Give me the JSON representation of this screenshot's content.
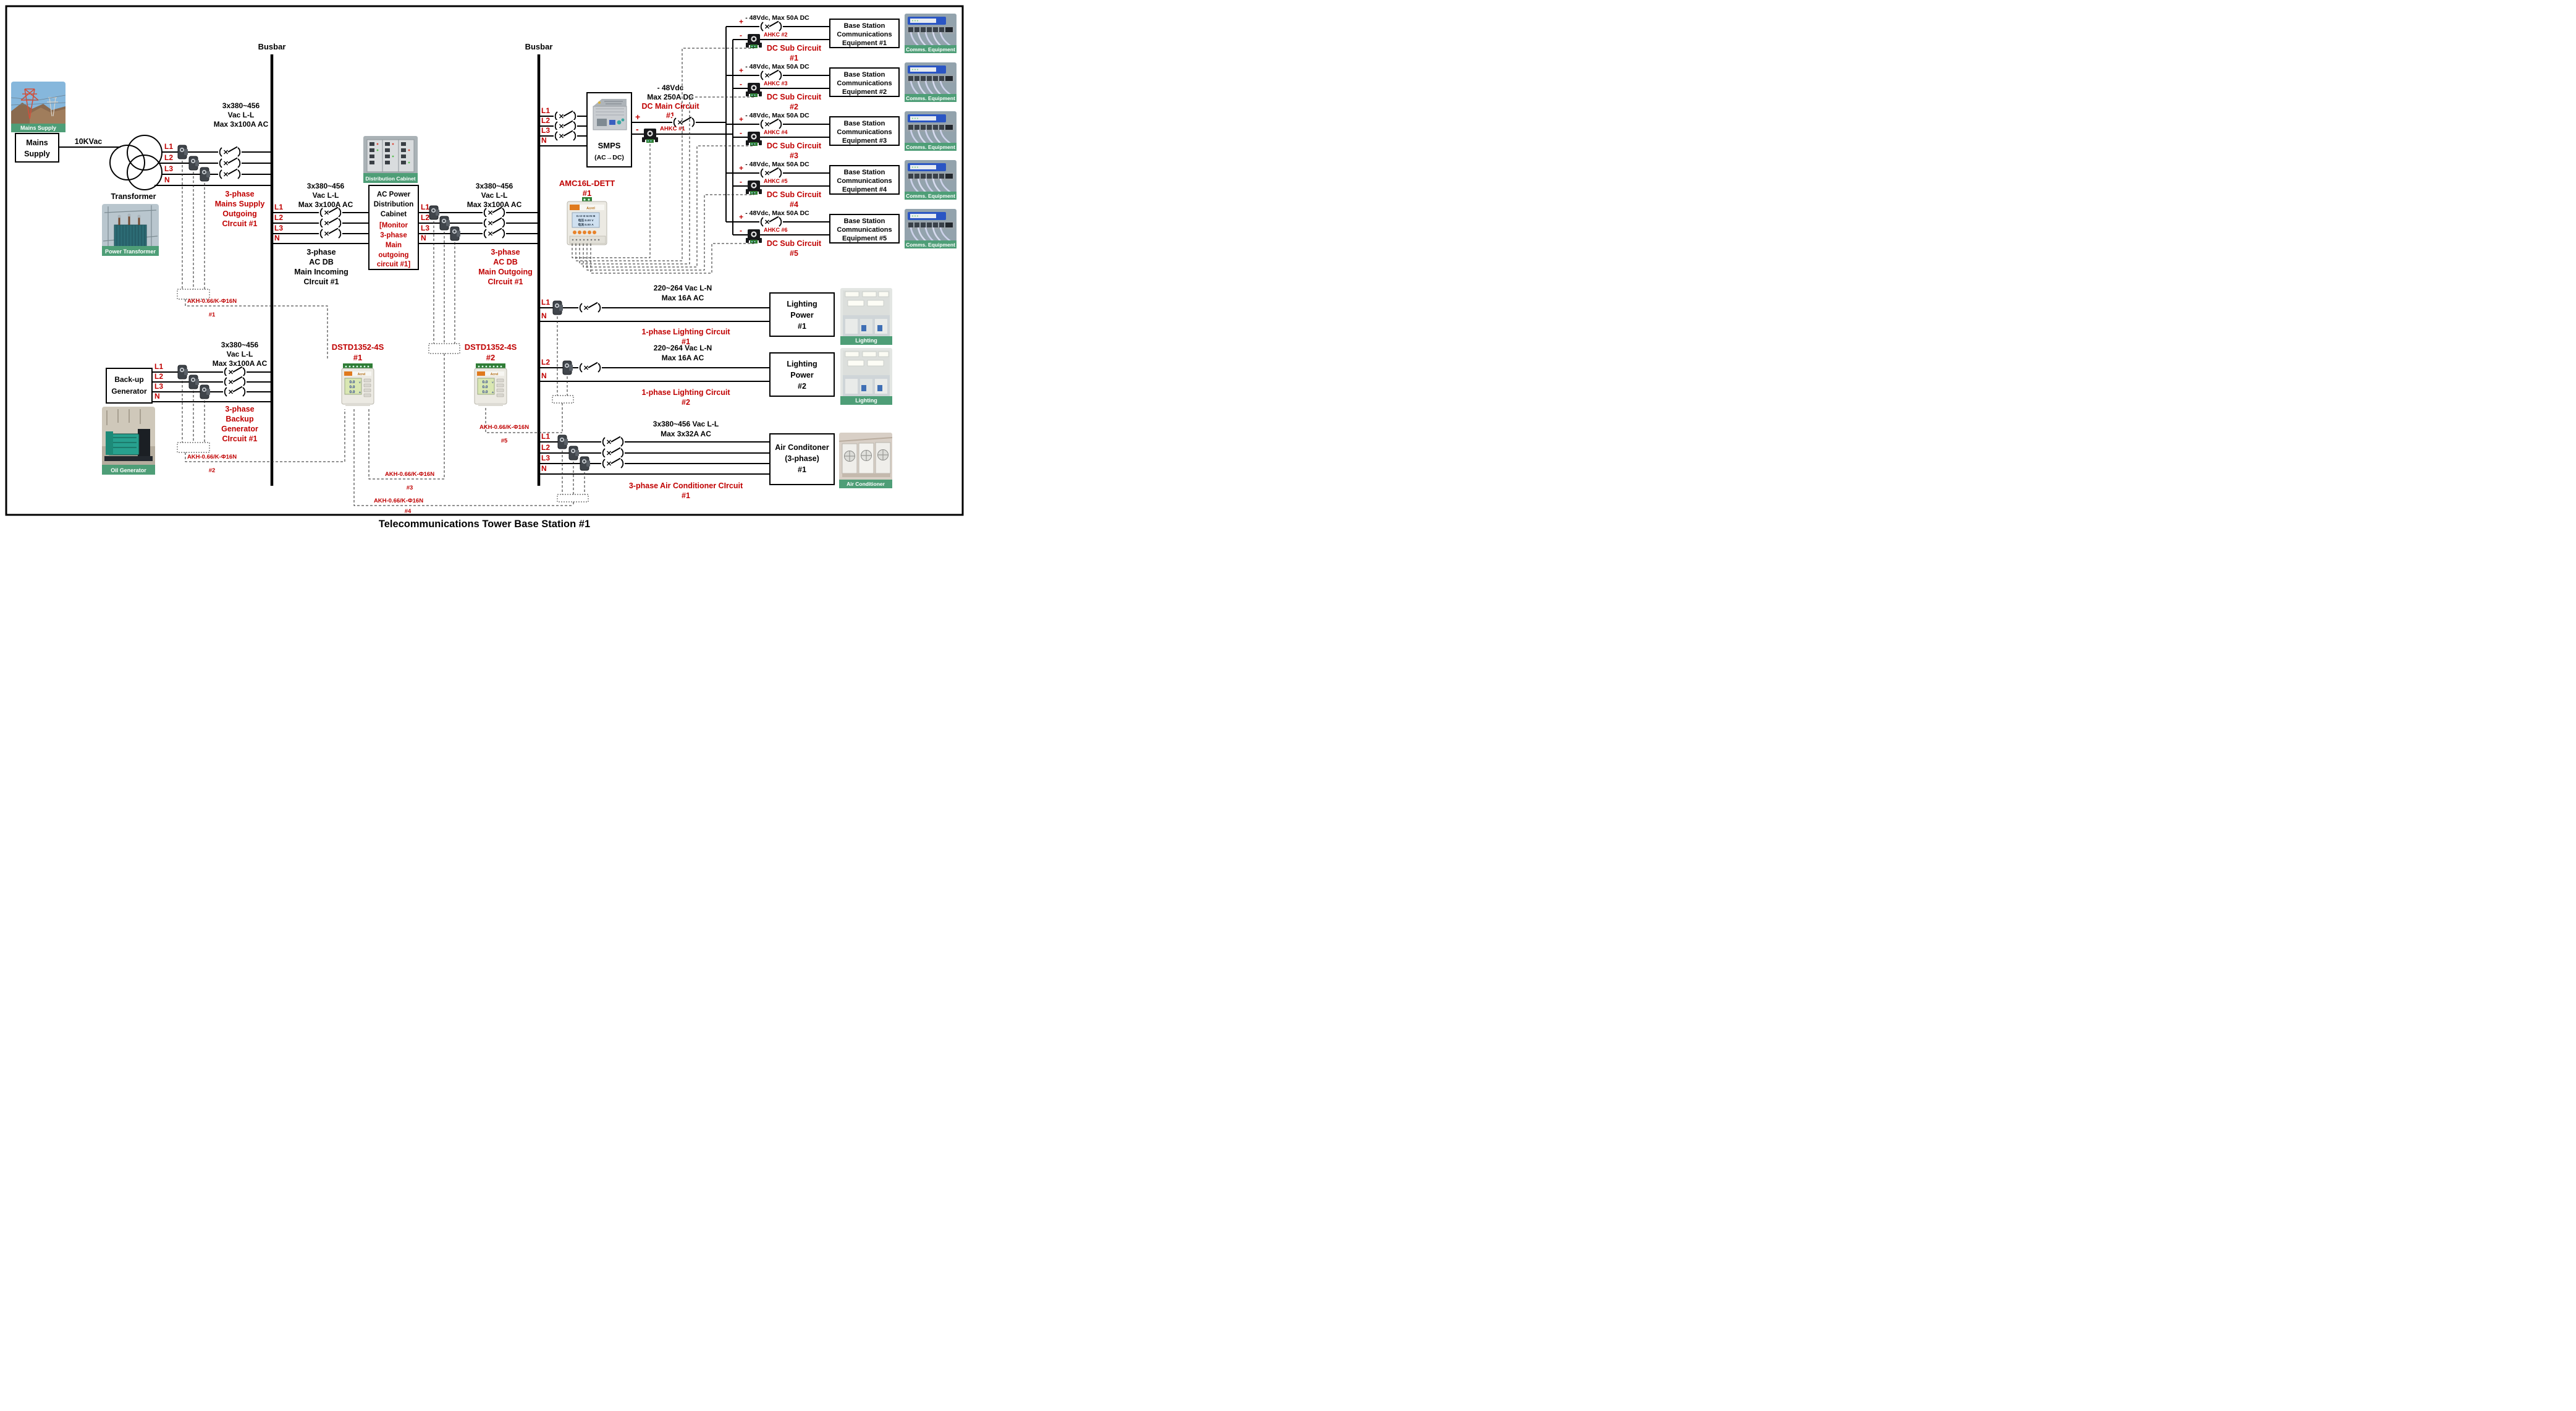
{
  "diagram": {
    "title": "Telecommunications Tower Base Station #1",
    "busbar_label": "Busbar"
  },
  "colors": {
    "label_red": "#c00000",
    "caption_green": "#4e9e77",
    "line": "#000000"
  },
  "mains": {
    "photo_caption": "Mains Supply",
    "source_box": [
      "Mains",
      "Supply"
    ],
    "voltage": "10KVac",
    "transformer_label": "Transformer",
    "transformer_photo_caption": "Power Transformer",
    "phases": [
      "L1",
      "L2",
      "L3",
      "N"
    ],
    "rating": [
      "3x380~456",
      "Vac L-L",
      "Max 3x100A AC"
    ],
    "circuit": [
      "3-phase",
      "Mains Supply",
      "Outgoing",
      "CIrcuit #1"
    ],
    "ct_label": "AKH-0.66/K-Φ16N",
    "ct_num": "#1"
  },
  "generator": {
    "box": [
      "Back-up",
      "Generator"
    ],
    "photo_caption": "Oil Generator",
    "phases": [
      "L1",
      "L2",
      "L3",
      "N"
    ],
    "rating": [
      "3x380~456",
      "Vac L-L",
      "Max 3x100A AC"
    ],
    "circuit": [
      "3-phase",
      "Backup",
      "Generator",
      "CIrcuit #1"
    ],
    "ct_label": "AKH-0.66/K-Φ16N",
    "ct_num": "#2"
  },
  "ac_db_in": {
    "phases": [
      "L1",
      "L2",
      "L3",
      "N"
    ],
    "rating": [
      "3x380~456",
      "Vac L-L",
      "Max 3x100A AC"
    ],
    "circuit": [
      "3-phase",
      "AC DB",
      "Main Incoming",
      "CIrcuit #1"
    ]
  },
  "cabinet": {
    "photo_caption": "Distribution Cabinet",
    "name": [
      "AC Power",
      "Distribution",
      "Cabinet"
    ],
    "note": [
      "[Monitor",
      "3-phase",
      "Main",
      "outgoing",
      "circuit #1]"
    ]
  },
  "ac_db_out": {
    "phases": [
      "L1",
      "L2",
      "L3",
      "N"
    ],
    "rating": [
      "3x380~456",
      "Vac L-L",
      "Max 3x100A AC"
    ],
    "circuit": [
      "3-phase",
      "AC DB",
      "Main Outgoing",
      "CIrcuit #1"
    ],
    "ct_label": "AKH-0.66/K-Φ16N",
    "ct_num": "#3"
  },
  "meters": {
    "brand": "Acrel",
    "dstd_model": "DSTD1352-4S",
    "dstd1_num": "#1",
    "dstd2_num": "#2",
    "dstd_lcd": [
      "0.0",
      "0.0",
      "0.0"
    ],
    "lcd_units": [
      "V",
      "A"
    ],
    "amc_model": "AMC16L-DETT",
    "amc_num": "#1",
    "amc_lcd": [
      "I1 I2 I3 I4 I5 I6",
      "电压:0.00  V",
      "电流:0.00  A"
    ]
  },
  "smps": {
    "phases": [
      "L1",
      "L2",
      "L3",
      "N"
    ],
    "box": [
      "SMPS",
      "(AC→DC)"
    ],
    "dc_rating": [
      "- 48Vdc",
      "Max 250A DC"
    ],
    "circuit": [
      "DC Main Circuit",
      "#1"
    ],
    "plus": "+",
    "minus": "-",
    "sensor": "AHKC #1"
  },
  "dc_photo_caption": "Comms. Equipment",
  "dc_subs": [
    {
      "rating": "- 48Vdc, Max 50A DC",
      "plus": "+",
      "minus": "-",
      "sensor": "AHKC #2",
      "circuit": [
        "DC Sub Circuit",
        "#1"
      ],
      "equipment": [
        "Base Station",
        "Communications",
        "Equipment #1"
      ]
    },
    {
      "rating": "- 48Vdc, Max 50A DC",
      "plus": "+",
      "minus": "-",
      "sensor": "AHKC #3",
      "circuit": [
        "DC Sub Circuit",
        "#2"
      ],
      "equipment": [
        "Base Station",
        "Communications",
        "Equipment #2"
      ]
    },
    {
      "rating": "- 48Vdc, Max 50A DC",
      "plus": "+",
      "minus": "-",
      "sensor": "AHKC #4",
      "circuit": [
        "DC Sub Circuit",
        "#3"
      ],
      "equipment": [
        "Base Station",
        "Communications",
        "Equipment #3"
      ]
    },
    {
      "rating": "- 48Vdc, Max 50A DC",
      "plus": "+",
      "minus": "-",
      "sensor": "AHKC #5",
      "circuit": [
        "DC Sub Circuit",
        "#4"
      ],
      "equipment": [
        "Base Station",
        "Communications",
        "Equipment #4"
      ]
    },
    {
      "rating": "- 48Vdc, Max 50A DC",
      "plus": "+",
      "minus": "-",
      "sensor": "AHKC #6",
      "circuit": [
        "DC Sub Circuit",
        "#5"
      ],
      "equipment": [
        "Base Station",
        "Communications",
        "Equipment #5"
      ]
    }
  ],
  "lighting_photo_caption": "Lighting",
  "lighting_ct_label": "AKH-0.66/K-Φ16N",
  "lighting_ct_num": "#5",
  "lighting": [
    {
      "phase": "L1",
      "neutral": "N",
      "rating": [
        "220~264 Vac L-N",
        "Max 16A AC"
      ],
      "box": [
        "Lighting",
        "Power",
        "#1"
      ],
      "circuit": [
        "1-phase Lighting Circuit",
        "#1"
      ]
    },
    {
      "phase": "L2",
      "neutral": "N",
      "rating": [
        "220~264 Vac L-N",
        "Max 16A AC"
      ],
      "box": [
        "Lighting",
        "Power",
        "#2"
      ],
      "circuit": [
        "1-phase Lighting Circuit",
        "#2"
      ]
    }
  ],
  "aircon": {
    "phases": [
      "L1",
      "L2",
      "L3",
      "N"
    ],
    "rating": [
      "3x380~456 Vac L-L",
      "Max 3x32A AC"
    ],
    "box": [
      "Air Conditoner",
      "(3-phase)",
      "#1"
    ],
    "circuit": [
      "3-phase Air Conditioner CIrcuit",
      "#1"
    ],
    "photo_caption": "Air Conditioner",
    "ct_label": "AKH-0.66/K-Φ16N",
    "ct_num": "#4"
  }
}
